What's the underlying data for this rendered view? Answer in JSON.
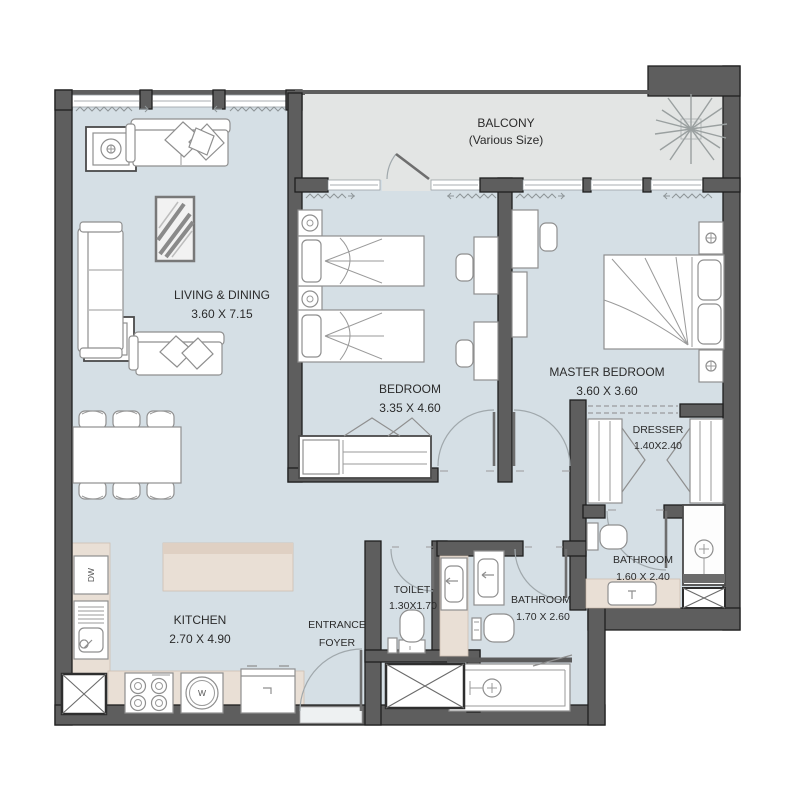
{
  "rooms": {
    "balcony": {
      "name": "BALCONY",
      "size": "(Various Size)"
    },
    "living_dining": {
      "name": "LIVING & DINING",
      "size": "3.60 X 7.15"
    },
    "bedroom": {
      "name": "BEDROOM",
      "size": "3.35 X 4.60"
    },
    "master_bedroom": {
      "name": "MASTER BEDROOM",
      "size": "3.60 X 3.60"
    },
    "dresser": {
      "name": "DRESSER",
      "size": "1.40X2.40"
    },
    "bathroom_master": {
      "name": "BATHROOM",
      "size": "1.60 X 2.40"
    },
    "bathroom": {
      "name": "BATHROOM",
      "size": "1.70 X 2.60"
    },
    "toilet": {
      "name": "TOILET",
      "size": "1.30X1.70"
    },
    "entrance_foyer": {
      "line1": "ENTRANCE",
      "line2": "FOYER"
    },
    "kitchen": {
      "name": "KITCHEN",
      "size": "2.70 X 4.90"
    }
  },
  "appliances": {
    "dishwasher": "DW",
    "washer": "W"
  },
  "colors": {
    "floor": "#d5dfe5",
    "balcony_floor": "#e3e5e4",
    "wall": "#5e5e5e",
    "counter": "#e9dfd5",
    "text": "#2b2b2b"
  }
}
